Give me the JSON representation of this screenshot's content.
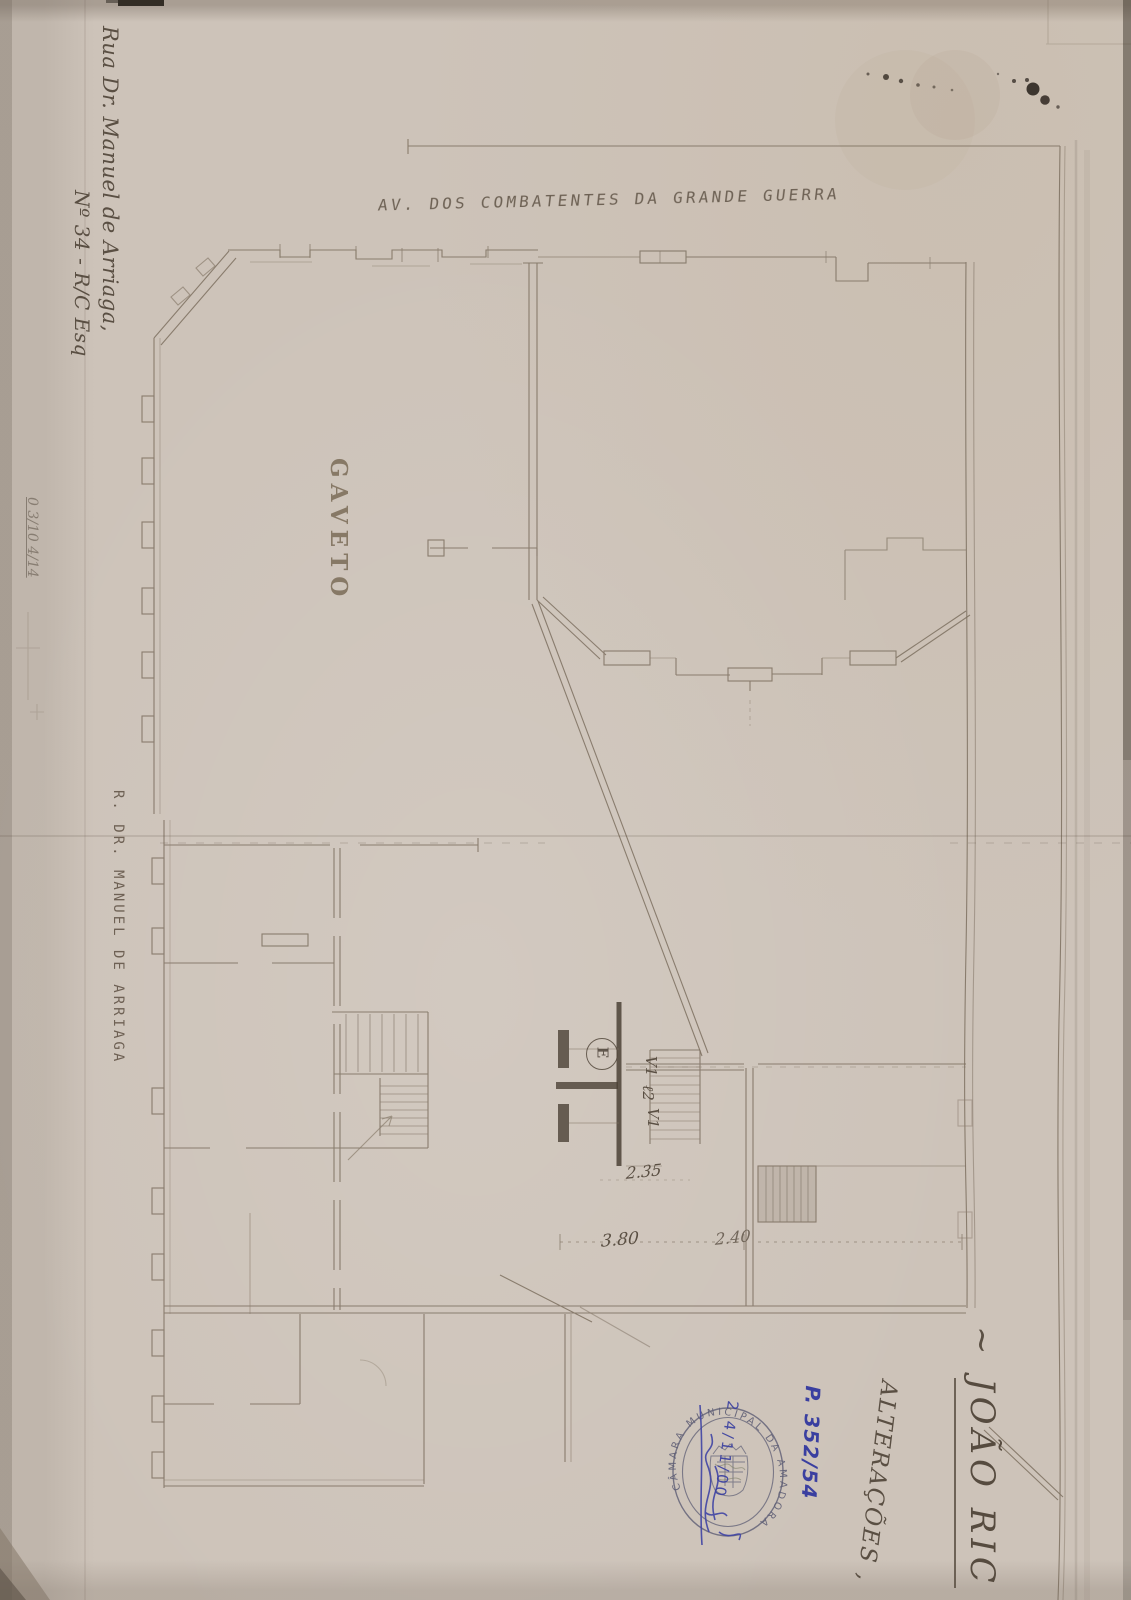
{
  "annotations": {
    "avenue": "AV. DOS COMBATENTES DA GRANDE GUERRA",
    "address_line1": "Rua Dr. Manuel de Arriaga,",
    "address_line2": "Nº 34 - R/C Esq",
    "corner": "GAVETO",
    "street": "R. DR. MANUEL DE ARRIAGA",
    "pencil_ref": "0 3/10 4/14",
    "tilde": "~",
    "owner_name": "JOÃO RIC",
    "subject": "ALTERAÇÕES ,"
  },
  "plan": {
    "entrance_label": "E",
    "window_label_top": "V1",
    "door_label": "ℓ2",
    "window_label_bottom": "V1",
    "dim_hall": "2.35",
    "dim_left": "3.80",
    "dim_right": "2.40"
  },
  "stamp": {
    "ring_text": "CÂMARA MUNICIPAL DA AMADORA",
    "process_no": "P. 352/54",
    "handwritten_date": "2 4/11/00"
  },
  "colors": {
    "paper": "#cdc3b9",
    "pencil": "#7d7060",
    "graphite_dark": "#564b3f",
    "stamp_blue": "#5d5d74",
    "ink_blue": "#3a3fa0"
  }
}
